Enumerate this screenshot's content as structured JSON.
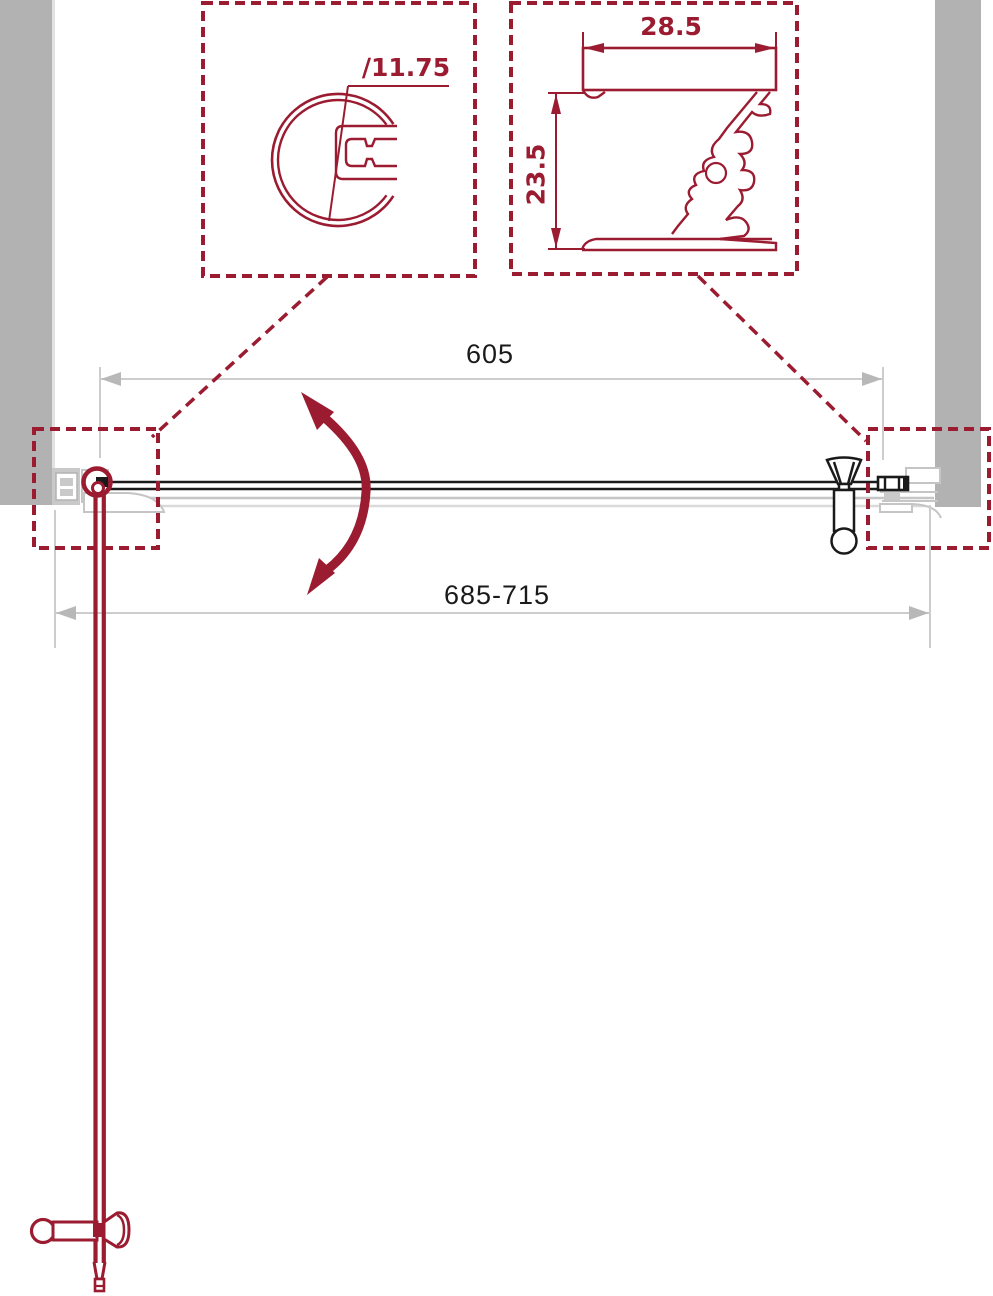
{
  "dimensions": {
    "door_glass_width": "605",
    "opening_adjustment_range": "685-715",
    "knob_profile_diameter": "∕11.75",
    "wall_profile_width": "28.5",
    "wall_profile_depth": "23.5"
  },
  "colors": {
    "accent_red": "#9B1B31",
    "wall_gray": "#B2B2B2",
    "profile_gray": "#C6C6C6",
    "dimension_gray": "#CDCDCD",
    "line_black": "#1A1A1A"
  }
}
